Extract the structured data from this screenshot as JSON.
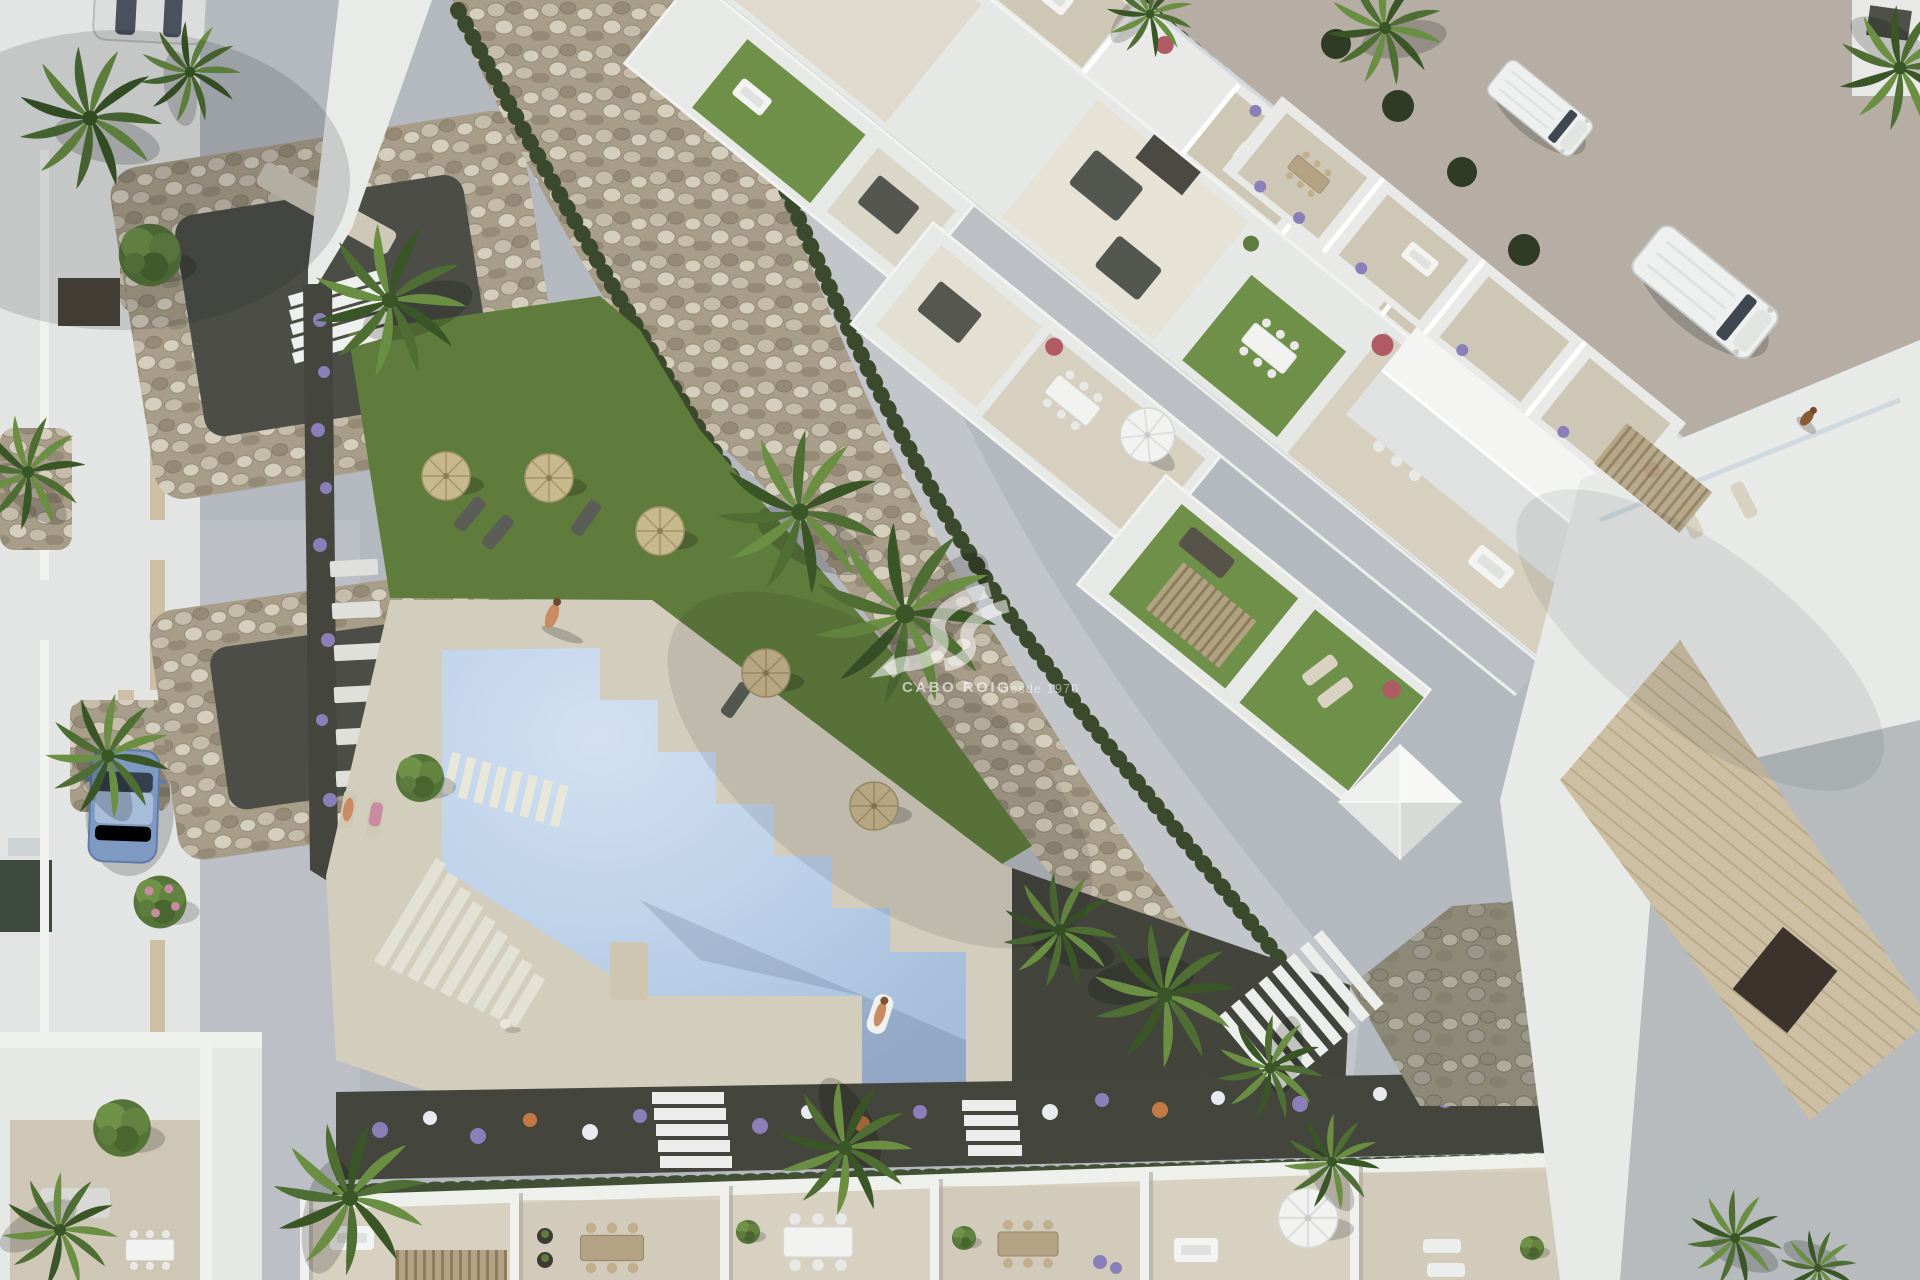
{
  "image": {
    "kind": "architectural-aerial-render",
    "width": 1920,
    "height": 1280,
    "description": "Top-down 3D render of a Mediterranean residential development: central white apartment blocks with rooftop lawn terraces, a communal pool with sun deck and straw umbrellas, a diagonal river-rock landscaping band with clipped hedges, surrounding streets with parked vehicles and a row of townhouse terraces along the bottom."
  },
  "watermark": {
    "brand": "CABO ROIG",
    "tagline": "Desde 1970",
    "logo": "wave-arrow-monogram",
    "color": "#ffffff"
  },
  "palette": {
    "street": "#b4b8bf",
    "streetLight": "#c6c9ce",
    "road": "#b6aea5",
    "rockBg": "#a89d89",
    "rockA": "#c6bcaa",
    "rockB": "#948a76",
    "rockC": "#d6cebc",
    "rockGap": "#6e6655",
    "rockDark": "#8d8979",
    "hedge": "#3b4a2c",
    "lawn": "#5f7c3c",
    "lawnRoof": "#6f9048",
    "water": "#b9cfe7",
    "waterLight": "#d3e0f2",
    "deck": "#d3cdbd",
    "white": "#edefec",
    "wallShadow": "#99a0a8",
    "terrace": "#d8d1c2",
    "terraceB": "#cfc7b6",
    "gravelDark": "#43453d",
    "soil": "#44453c",
    "path": "#c2c5c9",
    "wood": "#8e7c5c",
    "woodLight": "#b3a384",
    "straw": "#c8b88e",
    "parasol": "#f2f3f1",
    "flowerPurple": "#8a7fb8",
    "flowerWhite": "#e9eaf0",
    "flowerOrange": "#c27a45",
    "flowerPink": "#c98ba2",
    "flowerRed": "#b05a64",
    "palmA": "#4e6e33",
    "palmB": "#6b8f42",
    "palmDark": "#3a5526",
    "carBlue": "#7e9ac3",
    "vanWhite": "#eef0ef",
    "tile": "#cdbfa4",
    "roofGray": "#b7bbbe",
    "dogBrown": "#8a5c34",
    "skin": "#c98b62",
    "watermark": "#ffffff"
  },
  "scene": {
    "areas": [
      "left street with gravel planting islands",
      "left townhouse roofs",
      "diagonal river-rock band with hedges",
      "main apartment complex with rooftop lawns and terraces",
      "communal lawn with straw umbrellas and loungers",
      "swimming pool with stepped edge and sun deck",
      "flower border with stepping stones",
      "bottom townhouse terrace row",
      "top-right access road",
      "right building with grey roof and tiled band",
      "stone retaining wall with staircases"
    ],
    "vehicles": [
      {
        "type": "parked blue car",
        "color": "#7e9ac3"
      },
      {
        "type": "driving white van",
        "color": "#eef0ef"
      },
      {
        "type": "parked white van",
        "color": "#eef0ef"
      },
      {
        "type": "parked silver car",
        "color": "#dcdedd"
      }
    ],
    "pool": {
      "water_color": "#b9cfe7",
      "features": [
        "stepped diagonal edge",
        "slat bridge steps",
        "zigzag stair",
        "diving platform",
        "swimmer on float"
      ]
    },
    "umbrellas": {
      "straw_count": 5,
      "white_count": 2
    },
    "people": [
      "sunbather on deck",
      "swimmer on pool float",
      "two people on loungers by pool"
    ],
    "animals": [
      "dog on road",
      "duck on pool deck"
    ]
  }
}
